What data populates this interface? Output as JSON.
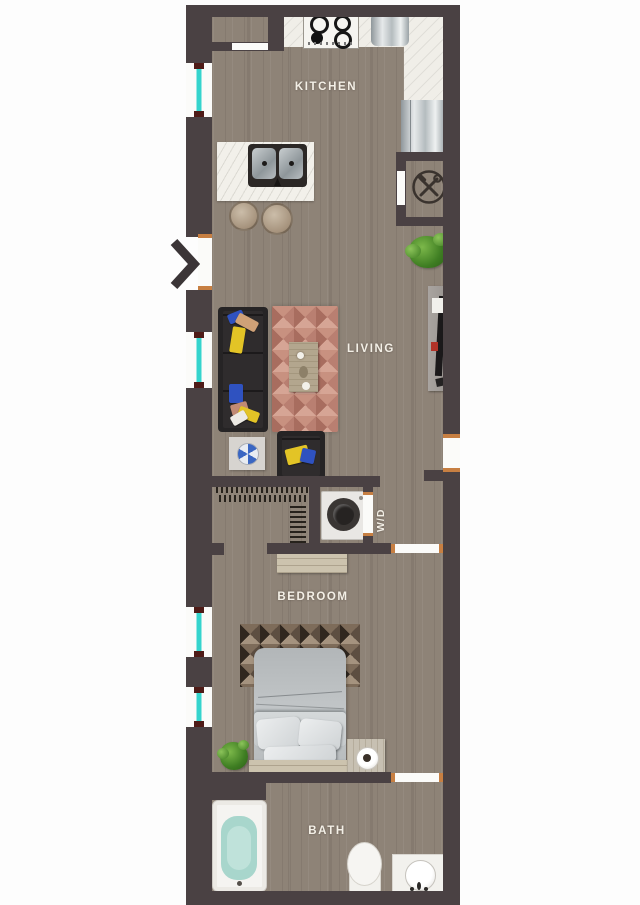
{
  "title": "Studio apartment floor plan",
  "rooms": [
    {
      "label": "KITCHEN"
    },
    {
      "label": "LIVING"
    },
    {
      "label": "W/D"
    },
    {
      "label": "BEDROOM"
    },
    {
      "label": "BATH"
    }
  ],
  "icons": {
    "entry": "chevron-right",
    "utility_closet": "crossed-hammer-wrench"
  },
  "colors": {
    "wall": "#4a4143",
    "floor_wood": "#8e8377",
    "counter": "#f0eee8",
    "window_glass": "#35d4cd",
    "door_jamb": "#c77f42",
    "rug": "#c58d7f",
    "pillow_yellow": "#e3c426",
    "pillow_blue": "#2f52c0",
    "tub_water": "#a8d6cc",
    "label_text": "#f3efe6"
  }
}
